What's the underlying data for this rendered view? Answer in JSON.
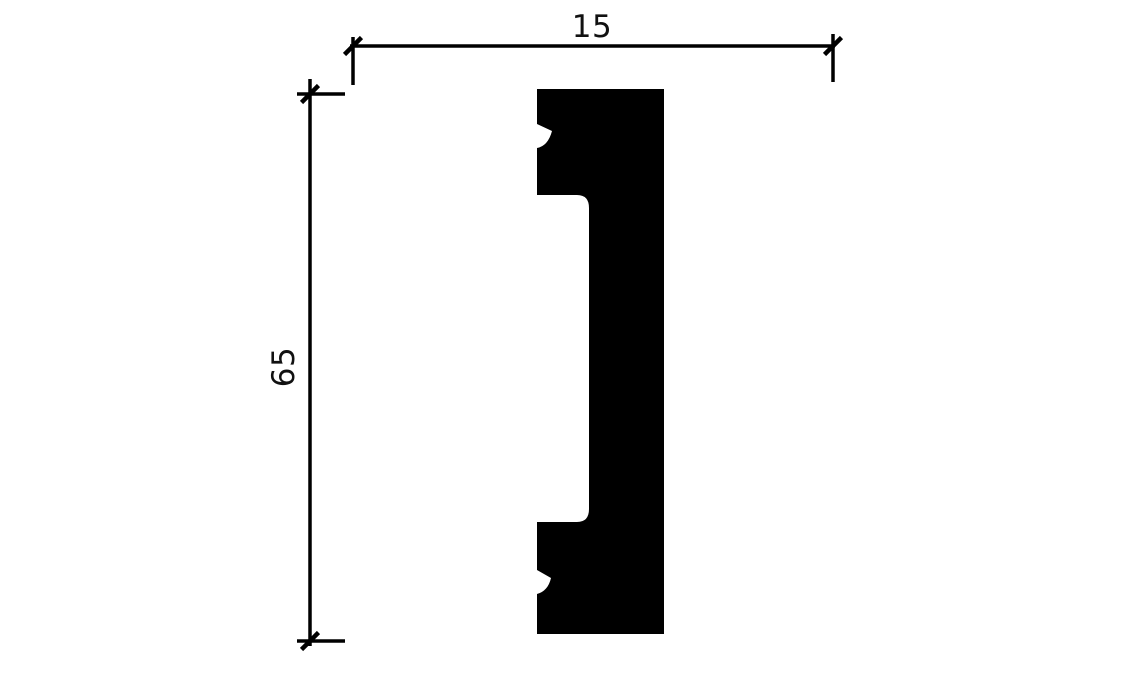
{
  "diagram": {
    "type": "technical-drawing",
    "subject": "molding-profile-cross-section",
    "background_color": "#ffffff",
    "line_color": "#000000",
    "shape_fill_color": "#000000",
    "text_color": "#111111",
    "dimensions": {
      "width": {
        "label": "15",
        "orientation": "horizontal",
        "position": "top"
      },
      "height": {
        "label": "65",
        "orientation": "vertical",
        "position": "left"
      }
    },
    "tick_style": "45-degree-slash",
    "notch_count": 2
  }
}
